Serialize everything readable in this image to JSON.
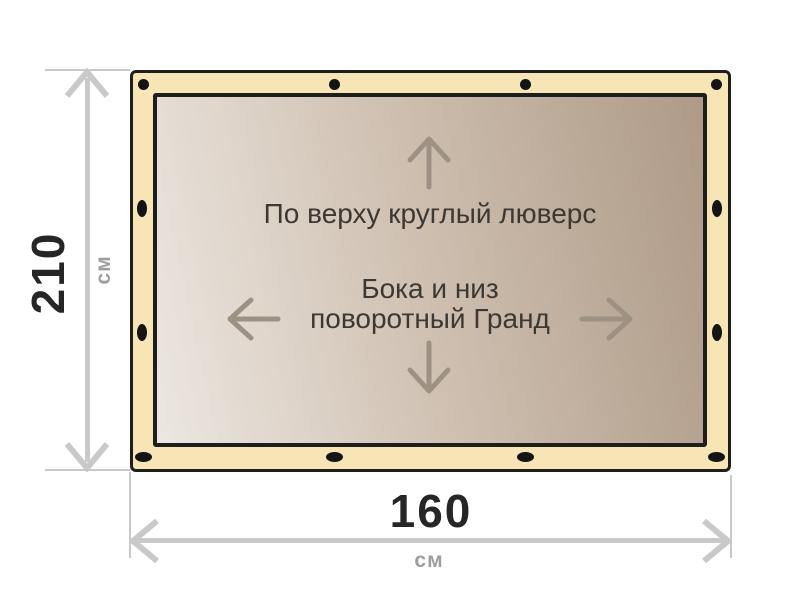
{
  "diagram_title": "tarpaulin-size-diagram",
  "dimensions": {
    "height": {
      "value": "210",
      "unit": "см"
    },
    "width": {
      "value": "160",
      "unit": "см"
    }
  },
  "panel": {
    "top_note": "По верху круглый люверс",
    "center_note_line1": "Бока и низ",
    "center_note_line2": "поворотный Гранд"
  },
  "icons": {
    "panel_arrows": [
      "arrow-up-icon",
      "arrow-left-icon",
      "arrow-right-icon",
      "arrow-down-icon"
    ],
    "dimension_arrows": [
      "dimension-arrow-up-icon",
      "dimension-arrow-down-icon",
      "dimension-arrow-left-icon",
      "dimension-arrow-right-icon"
    ],
    "grommets": [
      "grommet-circle",
      "grommet-vertical-oval",
      "grommet-horizontal-oval"
    ]
  },
  "tarp": {
    "grommets": [
      {
        "shape": "circle",
        "x": 10,
        "y": 11
      },
      {
        "shape": "circle",
        "x": 201,
        "y": 11
      },
      {
        "shape": "circle",
        "x": 392,
        "y": 11
      },
      {
        "shape": "circle",
        "x": 583,
        "y": 11
      },
      {
        "shape": "vertical_oval",
        "x": 9,
        "y": 135
      },
      {
        "shape": "vertical_oval",
        "x": 9,
        "y": 259
      },
      {
        "shape": "vertical_oval",
        "x": 584,
        "y": 135
      },
      {
        "shape": "vertical_oval",
        "x": 584,
        "y": 259
      },
      {
        "shape": "horizontal_oval",
        "x": 10,
        "y": 384
      },
      {
        "shape": "horizontal_oval",
        "x": 201,
        "y": 384
      },
      {
        "shape": "horizontal_oval",
        "x": 392,
        "y": 384
      },
      {
        "shape": "horizontal_oval",
        "x": 583,
        "y": 384
      }
    ]
  },
  "colors": {
    "background": "#ffffff",
    "tarp-hem": "#f7e5b6",
    "tarp-border": "#1e1e1e",
    "grommet": "#141414",
    "panel-gradient-light": "#ece7e1",
    "panel-gradient-mid": "#cfc0b1",
    "panel-gradient-dark": "#ae9a87",
    "panel-text": "#3c3833",
    "panel-arrow": "#9c9183",
    "dimension-line": "#c9c9c9",
    "dimension-number": "#262626",
    "dimension-unit": "#9e9e9e"
  }
}
